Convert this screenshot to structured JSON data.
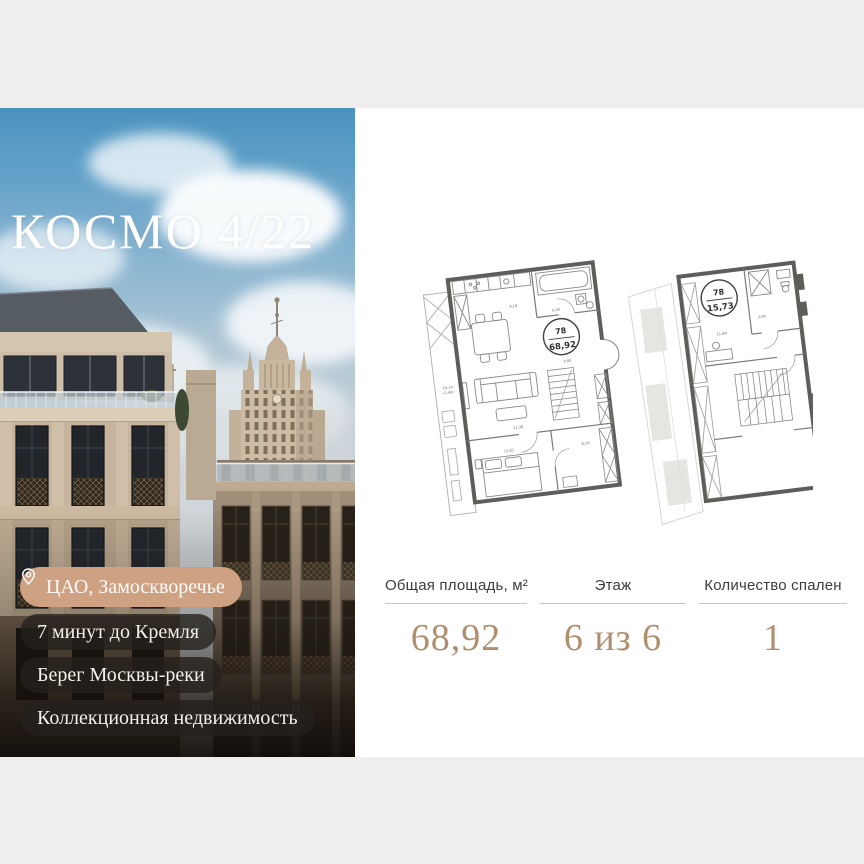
{
  "photo": {
    "title": "КОСМО 4/22",
    "badges": [
      {
        "label": "ЦАО, Замоскворечье",
        "icon": "location-pin",
        "style": "accent"
      },
      {
        "label": "7 минут до Кремля",
        "style": "dark"
      },
      {
        "label": "Берег Москвы-реки",
        "style": "dark"
      },
      {
        "label": "Коллекционная недвижимость",
        "style": "dark"
      }
    ]
  },
  "plans": {
    "plan1": {
      "unit": "78",
      "area": "68,92",
      "rooms": {
        "balcony_a": "10,14",
        "balcony_b": "(3,44)",
        "kitchen": "9,18",
        "bath": "6,00",
        "hall": "9,80",
        "living": "11,38",
        "bedroom": "12,93",
        "second": "8,16"
      }
    },
    "plan2": {
      "unit": "78",
      "area": "15,73",
      "rooms": {
        "room": "11,84",
        "bath": "3,89"
      }
    }
  },
  "stats": {
    "columns": [
      {
        "label": "Общая площадь, м²",
        "value": "68,92"
      },
      {
        "label": "Этаж",
        "value": "6 из 6"
      },
      {
        "label": "Количество спален",
        "value": "1"
      }
    ]
  },
  "colors": {
    "accent_tan": "#cfa183",
    "value_brown": "#b18f6e",
    "plan_wall": "#5e5d5a"
  }
}
